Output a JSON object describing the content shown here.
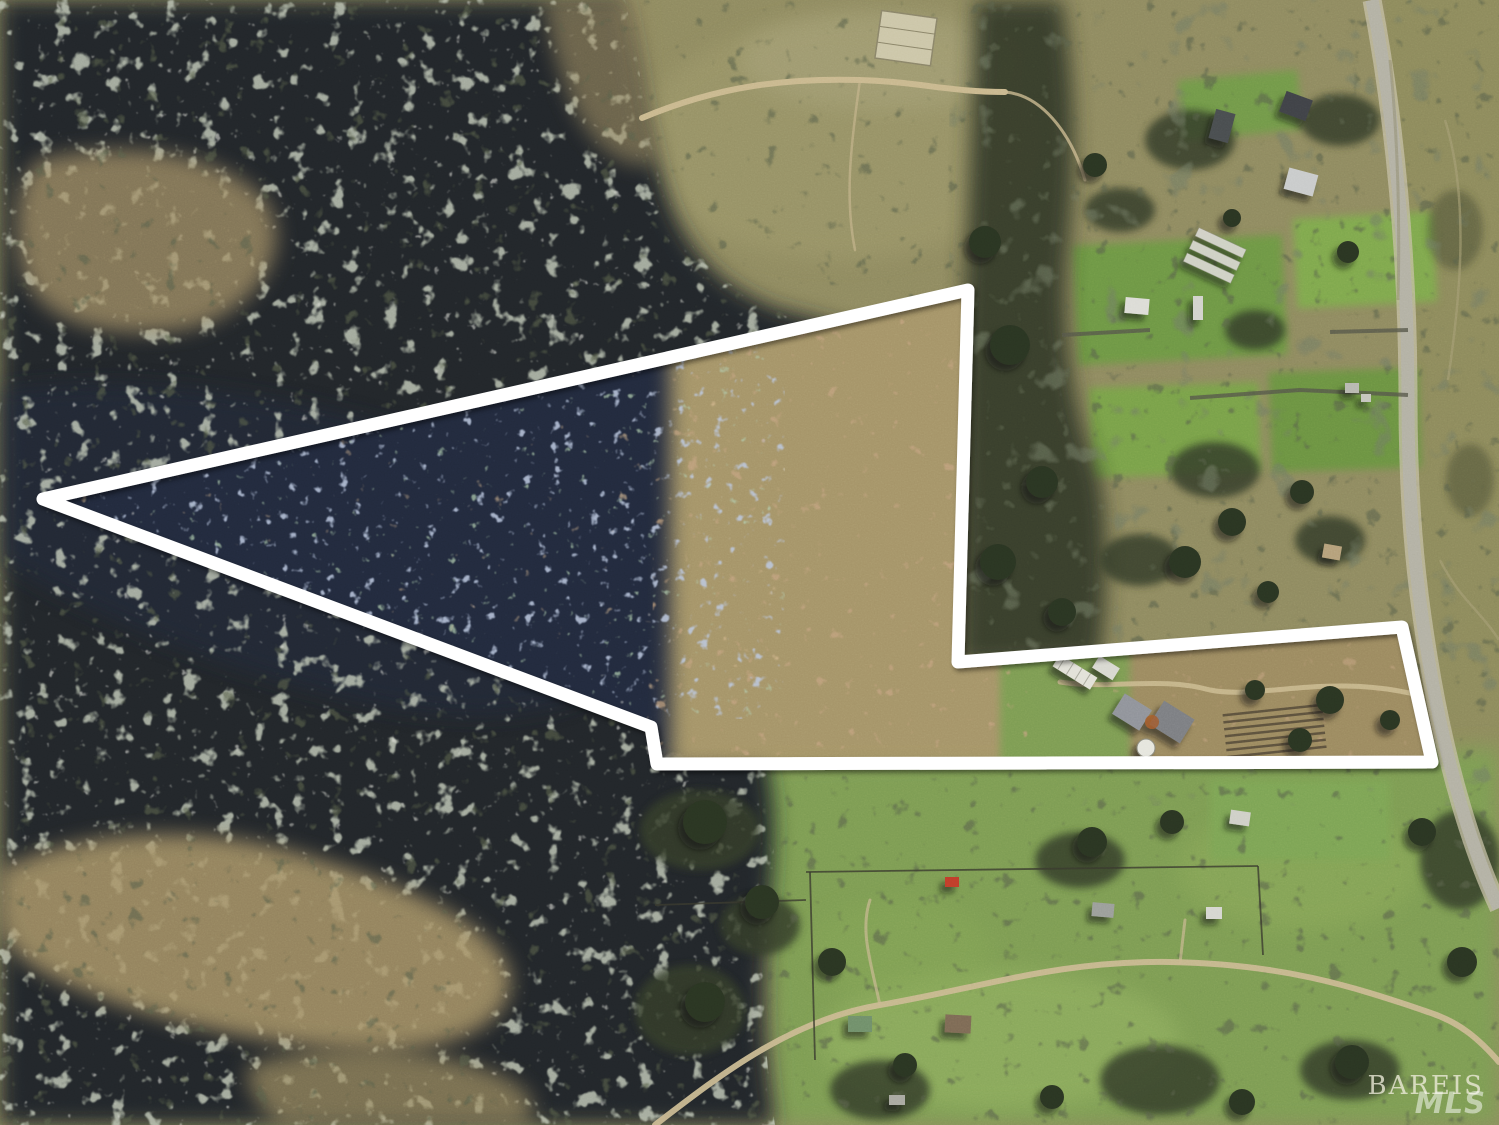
{
  "image": {
    "kind": "aerial drone photograph",
    "subject": "rural wooded acreage with white parcel boundary outline, neighboring small farms, pastures and a country road",
    "width_px": 1499,
    "height_px": 1125
  },
  "boundary": {
    "color": "#ffffff",
    "stroke_width": 13,
    "points": "43,499 968,290 958,662 1402,627 1432,762 657,764 651,727"
  },
  "watermark": {
    "line1": "BAREIS",
    "line2": "MLS"
  },
  "roads": {
    "paved_road_d": "M1372,0 C1395,120 1408,260 1408,400 C1408,520 1418,600 1432,680 C1448,770 1472,850 1499,908",
    "field_trail_d": "M642,118 C720,85 790,78 860,80 C920,82 950,92 1005,92",
    "farm_path_d": "M1060,682 C1110,690 1160,676 1210,690 C1260,700 1330,672 1422,696",
    "bottom_track_d": "M655,1125 C720,1075 790,1020 880,1005 C980,988 1060,960 1170,962 C1280,964 1350,985 1428,1012 C1460,1022 1480,1040 1499,1062"
  },
  "palette": {
    "boundary_white": "#ffffff",
    "forest_dark": "#23272b",
    "burn_navy": "#212a3e",
    "field_olive": "#8f8a60",
    "scrub_tan": "#a59467",
    "pasture_green": "#7d9c53",
    "lawn_green": "#6e9744",
    "road_gray": "#b3b1a4",
    "trail_tan": "#c9b88e"
  },
  "scene": {
    "regions": [
      "dense dark burned forest with sage and pale tree clusters over left half",
      "blue-tinted burned woodland inside left triangle of parcel",
      "tan cleared brushland in right half of triangle",
      "olive open scrub field across top center with dirt trail",
      "residential small farms with lawns, sheds and greenhouses along upper right",
      "paved country road running down right edge",
      "green pastures with scattered oaks across bottom",
      "farmstead with greenhouse, barns and water tank inside lower rectangular arm of parcel"
    ],
    "features": [
      "white parcel outline shaped like a left-pointing flag with rectangular arm to the right",
      "concrete pad in field near top center",
      "garden rows right of the farm buildings",
      "fence lines and dirt track through bottom pasture",
      "BAREIS MLS watermark lower right"
    ]
  }
}
